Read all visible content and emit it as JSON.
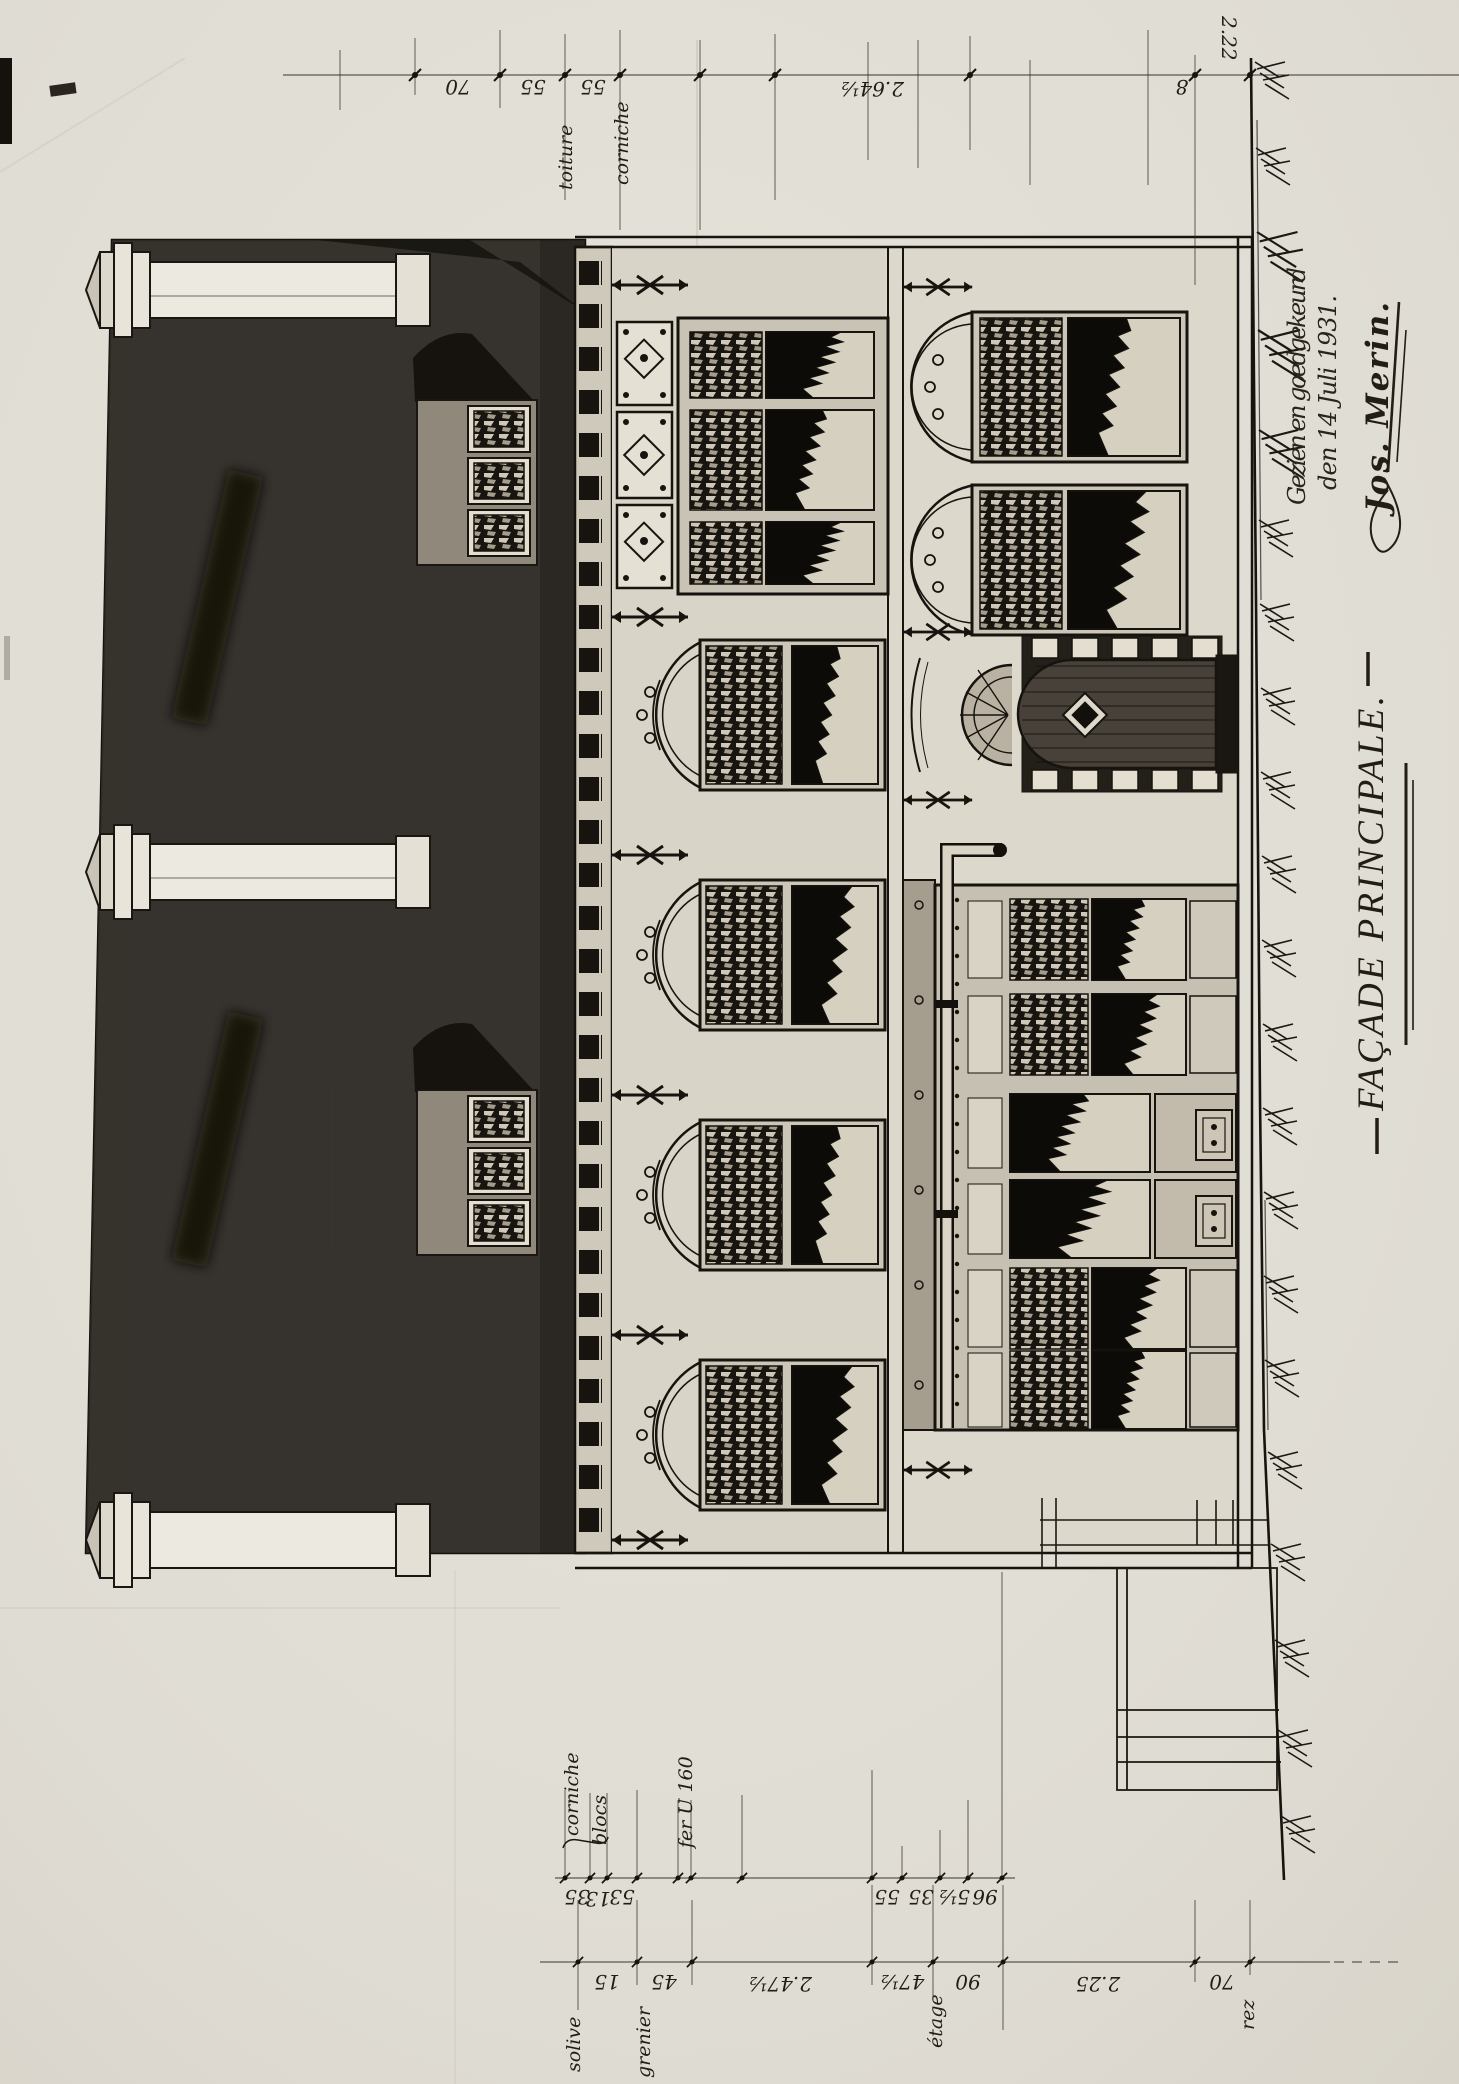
{
  "title": "FAÇADE PRINCIPALE.",
  "approval": {
    "line1": "Gezien en goedgekeurd",
    "line2": "den 14 Juli 1931.",
    "signature": "Jos. Merin."
  },
  "dimensions": {
    "top": {
      "values": [
        "70",
        "55",
        "55",
        "2.64½",
        "8",
        "2.22"
      ],
      "labels": [
        "toiture",
        "corniche"
      ]
    },
    "upper": {
      "values": [
        "35",
        "13",
        "53",
        "55",
        "35",
        "5½",
        "96"
      ],
      "labels": [
        "corniche",
        "blocs",
        "fer U 160"
      ]
    },
    "lower": {
      "values": [
        "15",
        "45",
        "2.47½",
        "47½",
        "90",
        "2.25",
        "70"
      ],
      "labels": [
        "solive",
        "grenier",
        "étage",
        "rez"
      ]
    }
  },
  "colors": {
    "paper": "#e9e6de",
    "ink": "#1c1813",
    "roof_wash": "#453f36",
    "wall_wash": "#d7d2c5",
    "glass_dark": "#0d0b08"
  }
}
